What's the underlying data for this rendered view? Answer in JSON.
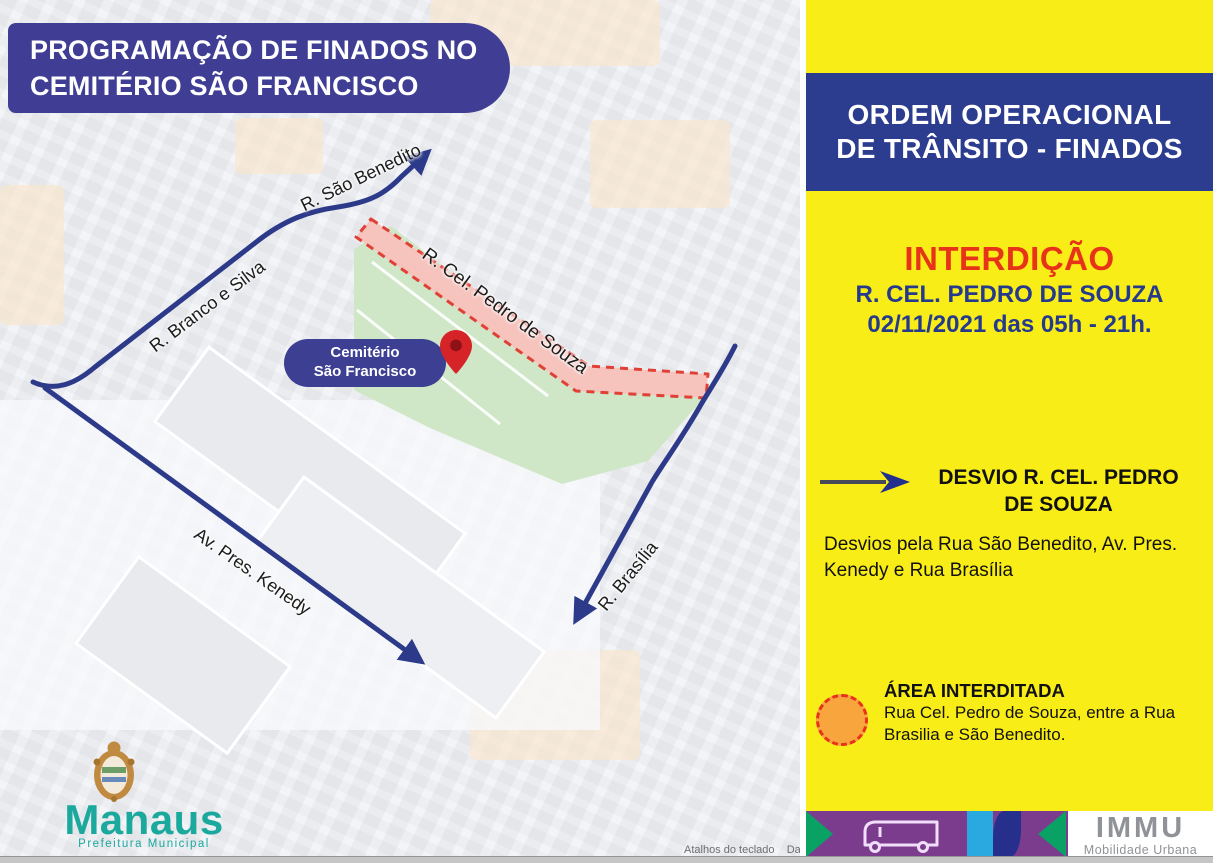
{
  "map": {
    "title": "PROGRAMAÇÃO DE FINADOS NO\nCEMITÉRIO SÃO FRANCISCO",
    "streets": {
      "sao_benedito": "R. São Benedito",
      "cel_pedro_de_souza": "R. Cel. Pedro de Souza",
      "branco_e_silva": "R. Branco e Silva",
      "pres_kenedy": "Av. Pres. Kenedy",
      "brasilia": "R. Brasília"
    },
    "cemetery_label": "Cemitério\nSão Francisco",
    "logo": {
      "city": "Manaus",
      "subtitle": "Prefeitura Municipal"
    },
    "attribution": "Atalhos do teclado    Da"
  },
  "panel": {
    "header_line1": "ORDEM OPERACIONAL",
    "header_line2": "DE TRÂNSITO - FINADOS",
    "interdicao": {
      "title": "INTERDIÇÃO",
      "street": "R. CEL. PEDRO DE SOUZA",
      "datetime": "02/11/2021 das 05h - 21h."
    },
    "desvio": {
      "title": "DESVIO R. CEL. PEDRO\nDE SOUZA",
      "description": "Desvios pela Rua São Benedito, Av. Pres.\nKenedy e Rua Brasília"
    },
    "area": {
      "title": "ÁREA INTERDITADA",
      "description": "Rua Cel. Pedro de Souza, entre a Rua\nBrasilia e São Benedito."
    },
    "footer": {
      "logo": "IMMU",
      "logo_subtitle": "Mobilidade Urbana"
    }
  },
  "colors": {
    "panel_yellow": "#f9ed17",
    "banner_navy": "#3f3d94",
    "header_blue": "#2c3c8e",
    "street_navy": "#2d3a8a",
    "alert_red": "#e8331a",
    "closed_corridor_fill": "#f6c3bd",
    "closed_corridor_border": "#e04136",
    "cemetery_green": "#cfe7c7",
    "legend_orange": "#f9a53d",
    "footer_purple": "#7b3c8e",
    "footer_green": "#0aa164",
    "footer_lightblue": "#2aa9e1",
    "manaus_teal": "#1ba99e",
    "immu_gray": "#8f9296"
  }
}
